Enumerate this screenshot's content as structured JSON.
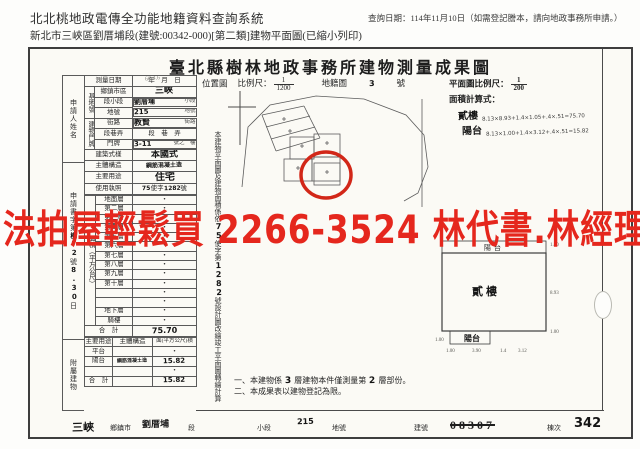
{
  "colors": {
    "watermark_red": "#e5271d",
    "circle_red": "#d22718",
    "ink": "#262626",
    "line": "#5a5a5a",
    "paper": "#fbfaf5"
  },
  "query_header": {
    "system_title": "北北桃地政電傳全功能地籍資料查詢系統",
    "query_date": "查詢日期：114年11月10日（如需登記謄本，請向地政事務所申請。）",
    "subtitle": "新北市三峽區劉厝埔段(建號:00342-000)[第二類]建物平面圖(已縮小列印)"
  },
  "title": "臺北縣樹林地政事務所建物測量成果圖",
  "watermark": "法拍屋輕鬆買 2266-3524 林代書.林經理",
  "form": {
    "applicant_label": "申請人姓名",
    "application_strip": {
      "pre": "申請書字第",
      "hand1": "樹72",
      "mid": "號",
      "hand2": "8.30",
      "suffix": "日"
    },
    "annex_group_label": "附屬建物",
    "area_group_label": "面積（平方公尺）",
    "rows": {
      "survey_date": {
        "label": "測量日期",
        "value": "年　月　日",
        "hand": "66.4.6"
      },
      "site_label": "基地號",
      "district": {
        "label": "鄉鎮市區",
        "hand": "三峽"
      },
      "section": {
        "label": "段小段",
        "hand": "劉厝埔",
        "suffix": "小段"
      },
      "parcel": {
        "label": "地號",
        "hand": "215",
        "suffix": "地號"
      },
      "door_label": "建物門牌",
      "street": {
        "label": "街路",
        "hand": "教賢",
        "suffix": "街路"
      },
      "lane": {
        "label": "段巷弄",
        "value": "段　巷　弄"
      },
      "door": {
        "label": "門牌",
        "hand": "3-11",
        "suffix": "號之　樓"
      },
      "style": {
        "label": "建築式樣",
        "hand": "本國式"
      },
      "structure": {
        "label": "主體構造",
        "hand": "鋼筋混凝土造"
      },
      "use": {
        "label": "主要用途",
        "hand": "住宅"
      },
      "license": {
        "label": "使用執照",
        "hand1": "75",
        "mid": "使字",
        "hand2": "1282",
        "suffix": "號"
      }
    },
    "floors": [
      {
        "label": "地面層",
        "value": "•"
      },
      {
        "label": "第二層",
        "value": "•"
      },
      {
        "label": "第三層",
        "value": "•"
      },
      {
        "label": "第四層",
        "value": "•"
      },
      {
        "label": "第五層",
        "value": "•"
      },
      {
        "label": "第六層",
        "value": "•"
      },
      {
        "label": "第七層",
        "value": "•"
      },
      {
        "label": "第八層",
        "value": "•"
      },
      {
        "label": "第九層",
        "value": "•"
      },
      {
        "label": "第十層",
        "value": "•"
      },
      {
        "label": "",
        "value": "•"
      },
      {
        "label": "",
        "value": "•"
      },
      {
        "label": "地下層",
        "value": "•"
      },
      {
        "label": "騎樓",
        "value": "•"
      }
    ],
    "floor_total": {
      "label": "合　計",
      "hand": "75.70"
    },
    "annex": {
      "headers": [
        "主要用途",
        "主體構造",
        "面(平方公尺)積"
      ],
      "rows": [
        {
          "use": "平台",
          "structure": "",
          "area": "•"
        },
        {
          "use": "陽台",
          "structure": "鋼筋混凝土造",
          "area": "15.82"
        },
        {
          "use": "",
          "structure": "",
          "area": "•"
        },
        {
          "use": "合　計",
          "structure": "",
          "area": "15.82"
        }
      ]
    }
  },
  "note_strip": {
    "a": "本建物平面圖及建物面積係依",
    "hand1": "75",
    "b": "使字第",
    "hand2": "1282",
    "c": "號設計圖改繪竣工平面圖轉繪計算"
  },
  "location_map": {
    "label": "位置圖",
    "scale_label": "比例尺：",
    "scale_num": "1",
    "scale_den": "1200",
    "ref_label": "地籍圖",
    "ref_hand": "3",
    "ref_suffix": "號"
  },
  "plan_scale": {
    "label": "平面圖比例尺：",
    "num": "1",
    "den": "200"
  },
  "area_calc": {
    "label": "面積計算式：",
    "rows": [
      {
        "name": "貳樓",
        "formula": "8.13×8.93+1.4×1.05+.4×.51=75.70"
      },
      {
        "name": "陽台",
        "formula": "8.13×1.00+1.4×3.12+.4×.51=15.82"
      }
    ]
  },
  "floor_plan": {
    "top_balcony": "陽台",
    "main": "貳樓",
    "bottom_balcony": "陽台",
    "dims": {
      "top_right": "1.00",
      "right": "8.93",
      "bottom_right": "1.00",
      "left": "1.00",
      "b1": "1.00",
      "b2": "3.90",
      "b3": "1.4",
      "b4": "3.12"
    }
  },
  "notes": {
    "n1a": "一、本建物係",
    "n1hand": "3",
    "n1b": "層建物本件僅測量第",
    "n1hand2": "2",
    "n1c": "層部份。",
    "n2": "二、本成果表以建物登記為限。"
  },
  "footer": {
    "town_hand": "三峽",
    "town_label": "鄉鎮市",
    "section_hand": "劉厝埔",
    "section_label": "段",
    "subsection_label": "小段",
    "parcel_hand": "215",
    "parcel_label": "地號",
    "building_label": "建號",
    "building_old": "08307",
    "unit_label": "棟次",
    "unit_value": "342"
  }
}
